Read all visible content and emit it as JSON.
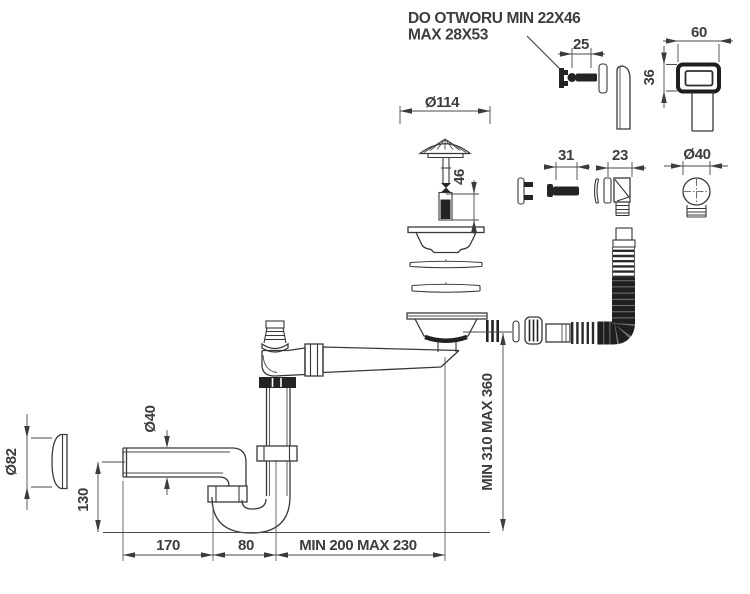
{
  "note": {
    "line1": "DO OTWORU MIN 22X46",
    "line2": "MAX 28X53"
  },
  "dimensions": {
    "overflow_screw": "25",
    "overflow_cover_width": "60",
    "overflow_cover_height": "36",
    "strainer_flange_diameter": "Ø114",
    "plug_height": "46",
    "connector_screw": "31",
    "overflow_elbow": "23",
    "overflow_hose_diameter": "Ø40",
    "installation_height": "MIN 310 MAX 360",
    "wall_rosette_diameter": "Ø82",
    "waste_pipe_diameter": "Ø40",
    "trap_depth": "130",
    "wall_to_trap": "170",
    "trap_width": "80",
    "trap_to_drain": "MIN 200 MAX 230"
  },
  "colors": {
    "line": "#383838",
    "dark_fill": "#242424",
    "background": "#ffffff"
  }
}
